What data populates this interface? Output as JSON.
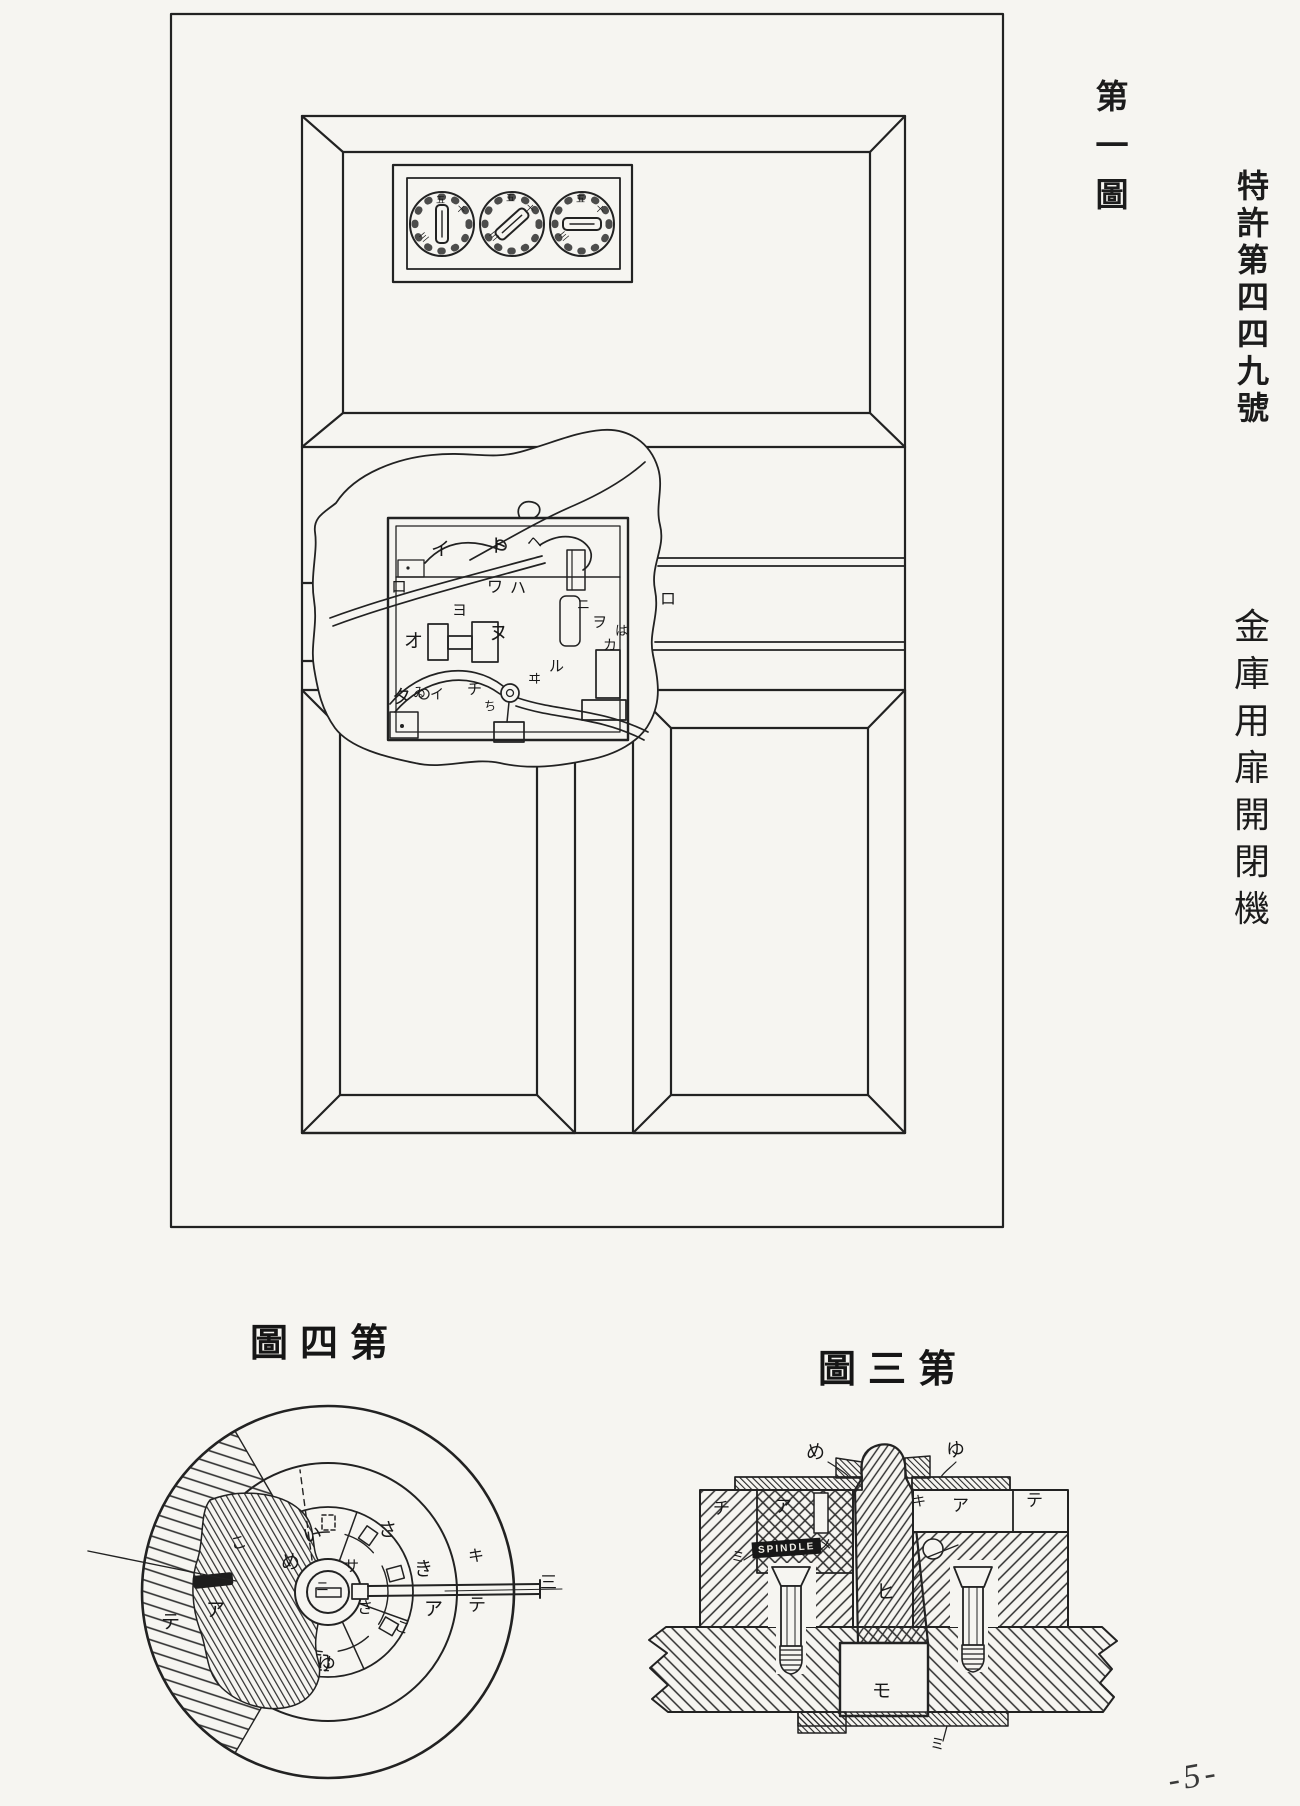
{
  "page": {
    "background": "#f6f5f1",
    "ink": "#1f1f1f",
    "page_number": "-5-"
  },
  "figure1": {
    "title_chars": [
      "第",
      "一",
      "圖"
    ],
    "labels": [
      {
        "t": "イ",
        "x": 431,
        "y": 540
      },
      {
        "t": "ト",
        "x": 489,
        "y": 537
      },
      {
        "t": "ヘ",
        "x": 527,
        "y": 536,
        "s": 15
      },
      {
        "t": "ロ",
        "x": 391,
        "y": 580,
        "s": 16
      },
      {
        "t": "ワ",
        "x": 487,
        "y": 580,
        "s": 16
      },
      {
        "t": "ハ",
        "x": 510,
        "y": 581,
        "s": 16
      },
      {
        "t": "ニ",
        "x": 577,
        "y": 598,
        "s": 13
      },
      {
        "t": "ヨ",
        "x": 452,
        "y": 604,
        "s": 15
      },
      {
        "t": "オ",
        "x": 404,
        "y": 632
      },
      {
        "t": "ヌ",
        "x": 489,
        "y": 624
      },
      {
        "t": "ヲ",
        "x": 592,
        "y": 616,
        "s": 15
      },
      {
        "t": "は",
        "x": 615,
        "y": 624,
        "s": 13
      },
      {
        "t": "カ",
        "x": 603,
        "y": 640,
        "s": 14
      },
      {
        "t": "ロ",
        "x": 660,
        "y": 592,
        "s": 16
      },
      {
        "t": "タ",
        "x": 392,
        "y": 688
      },
      {
        "t": "ゐ",
        "x": 413,
        "y": 686,
        "s": 13
      },
      {
        "t": "イ",
        "x": 430,
        "y": 689,
        "s": 14
      },
      {
        "t": "チ",
        "x": 467,
        "y": 683,
        "s": 15
      },
      {
        "t": "ち",
        "x": 484,
        "y": 700,
        "s": 12
      },
      {
        "t": "ヰ",
        "x": 528,
        "y": 672,
        "s": 13
      },
      {
        "t": "ル",
        "x": 549,
        "y": 660,
        "s": 15
      },
      {
        "t": "五",
        "x": 436,
        "y": 196,
        "s": 9
      },
      {
        "t": "十",
        "x": 456,
        "y": 205,
        "s": 9,
        "r": 45
      },
      {
        "t": "三",
        "x": 420,
        "y": 233,
        "s": 9,
        "r": -40
      },
      {
        "t": "五",
        "x": 506,
        "y": 194,
        "s": 9
      },
      {
        "t": "十",
        "x": 525,
        "y": 204,
        "s": 9,
        "r": 45
      },
      {
        "t": "三",
        "x": 490,
        "y": 232,
        "s": 9,
        "r": -40
      },
      {
        "t": "五",
        "x": 576,
        "y": 195,
        "s": 9
      },
      {
        "t": "十",
        "x": 595,
        "y": 205,
        "s": 9,
        "r": 45
      },
      {
        "t": "三",
        "x": 560,
        "y": 232,
        "s": 9,
        "r": -40
      }
    ]
  },
  "patent_header": {
    "line1_chars": [
      "特",
      "許",
      "第",
      "四",
      "四",
      "九",
      "號"
    ],
    "line2_chars": [
      "金",
      "庫",
      "用",
      "扉",
      "開",
      "閉",
      "機"
    ]
  },
  "figure4": {
    "title": "圖四第",
    "labels": [
      {
        "t": "い",
        "x": 303,
        "y": 1526,
        "r": -12
      },
      {
        "t": "さ",
        "x": 378,
        "y": 1521
      },
      {
        "t": "き",
        "x": 414,
        "y": 1560
      },
      {
        "t": "キ",
        "x": 468,
        "y": 1549,
        "s": 16
      },
      {
        "t": "テ",
        "x": 468,
        "y": 1596,
        "s": 18
      },
      {
        "t": "ア",
        "x": 424,
        "y": 1600
      },
      {
        "t": "さ",
        "x": 357,
        "y": 1601,
        "s": 16
      },
      {
        "t": "こ",
        "x": 394,
        "y": 1621,
        "s": 15,
        "r": 20
      },
      {
        "t": "ゆ",
        "x": 317,
        "y": 1655
      },
      {
        "t": "め",
        "x": 281,
        "y": 1553
      },
      {
        "t": "ニ",
        "x": 316,
        "y": 1580,
        "s": 13
      },
      {
        "t": "サ",
        "x": 344,
        "y": 1560,
        "s": 15
      },
      {
        "t": "こ",
        "x": 231,
        "y": 1536,
        "s": 16,
        "r": -15
      },
      {
        "t": "ア",
        "x": 206,
        "y": 1601
      },
      {
        "t": "テ",
        "x": 161,
        "y": 1613
      },
      {
        "t": "三",
        "x": 540,
        "y": 1574,
        "s": 17
      }
    ]
  },
  "figure3": {
    "title": "圖三第",
    "spindle_text": "SPINDLE",
    "labels": [
      {
        "t": "め",
        "x": 806,
        "y": 1443
      },
      {
        "t": "ゆ",
        "x": 946,
        "y": 1441
      },
      {
        "t": "チ",
        "x": 713,
        "y": 1500,
        "s": 17
      },
      {
        "t": "ア",
        "x": 775,
        "y": 1498,
        "s": 17
      },
      {
        "t": "ミ",
        "x": 731,
        "y": 1552,
        "s": 14
      },
      {
        "t": "メ",
        "x": 818,
        "y": 1540,
        "s": 14
      },
      {
        "t": "キ",
        "x": 912,
        "y": 1496,
        "s": 14
      },
      {
        "t": "ア",
        "x": 952,
        "y": 1497,
        "s": 17
      },
      {
        "t": "テ",
        "x": 1026,
        "y": 1492,
        "s": 17
      },
      {
        "t": "ヒ",
        "x": 876,
        "y": 1583
      },
      {
        "t": "モ",
        "x": 872,
        "y": 1682
      },
      {
        "t": "ミ",
        "x": 930,
        "y": 1738,
        "s": 15
      }
    ]
  }
}
